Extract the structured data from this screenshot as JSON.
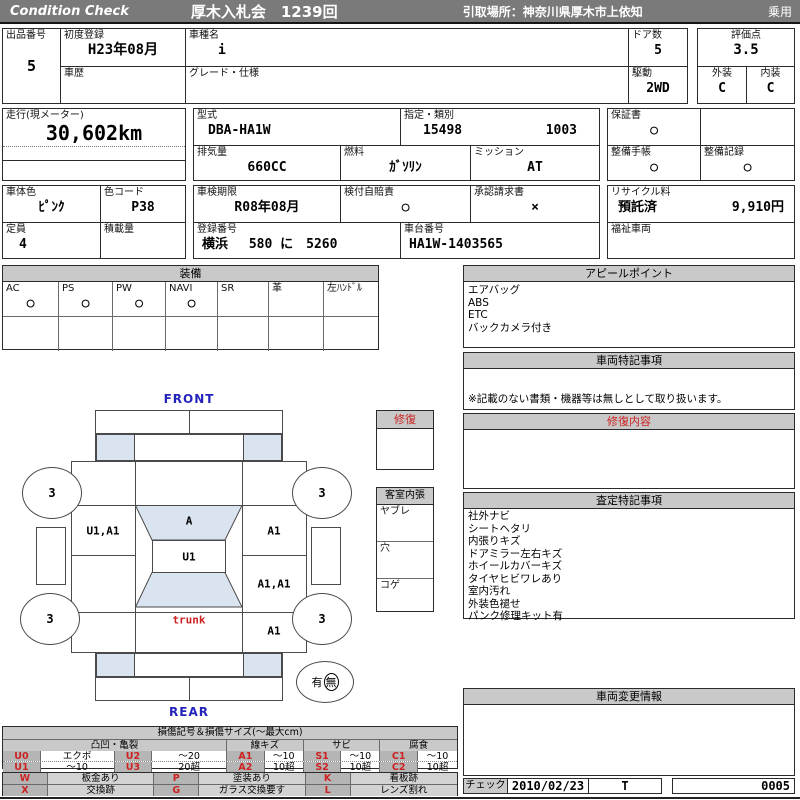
{
  "colors": {
    "bar_gray": "#7a7a7a",
    "header_gray": "#c9c9c9",
    "code_gray": "#b5b5b5",
    "glass_blue": "#dae4f0",
    "accent_red": "#cc2222",
    "accent_blue": "#2323bb"
  },
  "header": {
    "brand": "Condition  Check",
    "auction": "厚木入札会　1239回",
    "pickup": "引取場所：神奈川県厚木市上依知",
    "category": "乗用"
  },
  "info": {
    "lot_label": "出品番号",
    "lot": "5",
    "first_reg_label": "初度登録",
    "first_reg": "H23年08月",
    "history_label": "車歴",
    "history": "",
    "model_name_label": "車種名",
    "model_name": "i",
    "grade_label": "グレード・仕様",
    "grade": "",
    "doors_label": "ドア数",
    "doors": "5",
    "score_label": "評価点",
    "score": "3.5",
    "drive_label": "駆動",
    "drive": "2WD",
    "exterior_label": "外装",
    "exterior": "C",
    "interior_label": "内装",
    "interior": "C",
    "mileage_label": "走行(現メーター)",
    "mileage": "30,602km",
    "model_code_label": "型式",
    "model_code": "DBA-HA1W",
    "type_label": "指定・類別",
    "type_no": "15498",
    "class_no": "1003",
    "warranty_label": "保証書",
    "warranty": "○",
    "displacement_label": "排気量",
    "displacement": "660CC",
    "fuel_label": "燃料",
    "fuel": "ｶﾞｿﾘﾝ",
    "mission_label": "ミッション",
    "mission": "AT",
    "maintenance_book_label": "整備手帳",
    "maintenance_book": "○",
    "maintenance_record_label": "整備記録",
    "maintenance_record": "○",
    "color_label": "車体色",
    "color": "ﾋﾟﾝｸ",
    "color_code_label": "色コード",
    "color_code": "P38",
    "inspection_label": "車検期限",
    "inspection": "R08年08月",
    "insurance_label": "検付自賠責",
    "insurance": "○",
    "approval_label": "承認請求書",
    "approval": "×",
    "recycle_label": "リサイクル料",
    "recycle_status": "預託済",
    "recycle_fee": "9,910円",
    "capacity_label": "定員",
    "capacity": "4",
    "load_label": "積載量",
    "load": "",
    "reg_no_label": "登録番号",
    "reg_no": "横浜　 580 に　5260",
    "chassis_label": "車台番号",
    "chassis": "HA1W-1403565",
    "welfare_label": "福祉車両",
    "welfare": ""
  },
  "equipment": {
    "title": "装備",
    "items": [
      {
        "label": "AC",
        "mark": "○"
      },
      {
        "label": "PS",
        "mark": "○"
      },
      {
        "label": "PW",
        "mark": "○"
      },
      {
        "label": "NAVI",
        "mark": "○"
      },
      {
        "label": "SR",
        "mark": ""
      },
      {
        "label": "革",
        "mark": ""
      },
      {
        "label": "左ﾊﾝﾄﾞﾙ",
        "mark": ""
      }
    ]
  },
  "panels": {
    "appeal": {
      "title": "アピールポイント",
      "lines": [
        "エアバッグ",
        "ABS",
        "ETC",
        "バックカメラ付き"
      ]
    },
    "vehicle_notes": {
      "title": "車両特記事項",
      "note": "※記載のない書類・機器等は無しとして取り扱います。"
    },
    "repair": {
      "title": "修復内容"
    },
    "assessment": {
      "title": "査定特記事項",
      "lines": [
        "社外ナビ",
        "シートヘタリ",
        "内張りキズ",
        "ドアミラー左右キズ",
        "ホイールカバーキズ",
        "タイヤヒビワレあり",
        "室内汚れ",
        "外装色褪せ",
        "パンク修理キット有"
      ]
    },
    "change_info": {
      "title": "車両変更情報"
    },
    "check": {
      "label": "チェック",
      "date": "2010/02/23",
      "inspector": "T",
      "number": "0005"
    }
  },
  "diagram": {
    "front_label": "FRONT",
    "rear_label": "REAR",
    "repair_box_title": "修復",
    "cabin_box": {
      "title": "客室内張",
      "rows": [
        "ヤブレ",
        "穴",
        "コゲ"
      ]
    },
    "zones": {
      "left_front_door": "U1,A1",
      "windshield": "A",
      "right_front_door": "A1",
      "roof": "U1",
      "right_rear_door": "A1,A1",
      "trunk": "trunk",
      "right_quarter": "A1"
    },
    "wheels": {
      "front_left": "3",
      "front_right": "3",
      "rear_left": "3",
      "rear_right": "3"
    },
    "spare": {
      "yes": "有",
      "no": "無"
    }
  },
  "legend": {
    "title": "損傷記号＆損傷サイズ(～最大cm)",
    "groups": [
      "凸凹・亀裂",
      "線キズ",
      "サビ",
      "腐食"
    ],
    "size_rows": [
      [
        "U0",
        "エクボ",
        "U2",
        "～20",
        "A1",
        "～10",
        "S1",
        "～10",
        "C1",
        "～10"
      ],
      [
        "U1",
        "～10",
        "U3",
        "20超",
        "A2",
        "10超",
        "S2",
        "10超",
        "C2",
        "10超"
      ]
    ],
    "code_rows": [
      [
        "W",
        "板金あり",
        "P",
        "塗装あり",
        "K",
        "看板跡"
      ],
      [
        "X",
        "交換跡",
        "G",
        "ガラス交換要す",
        "L",
        "レンズ割れ"
      ]
    ]
  }
}
